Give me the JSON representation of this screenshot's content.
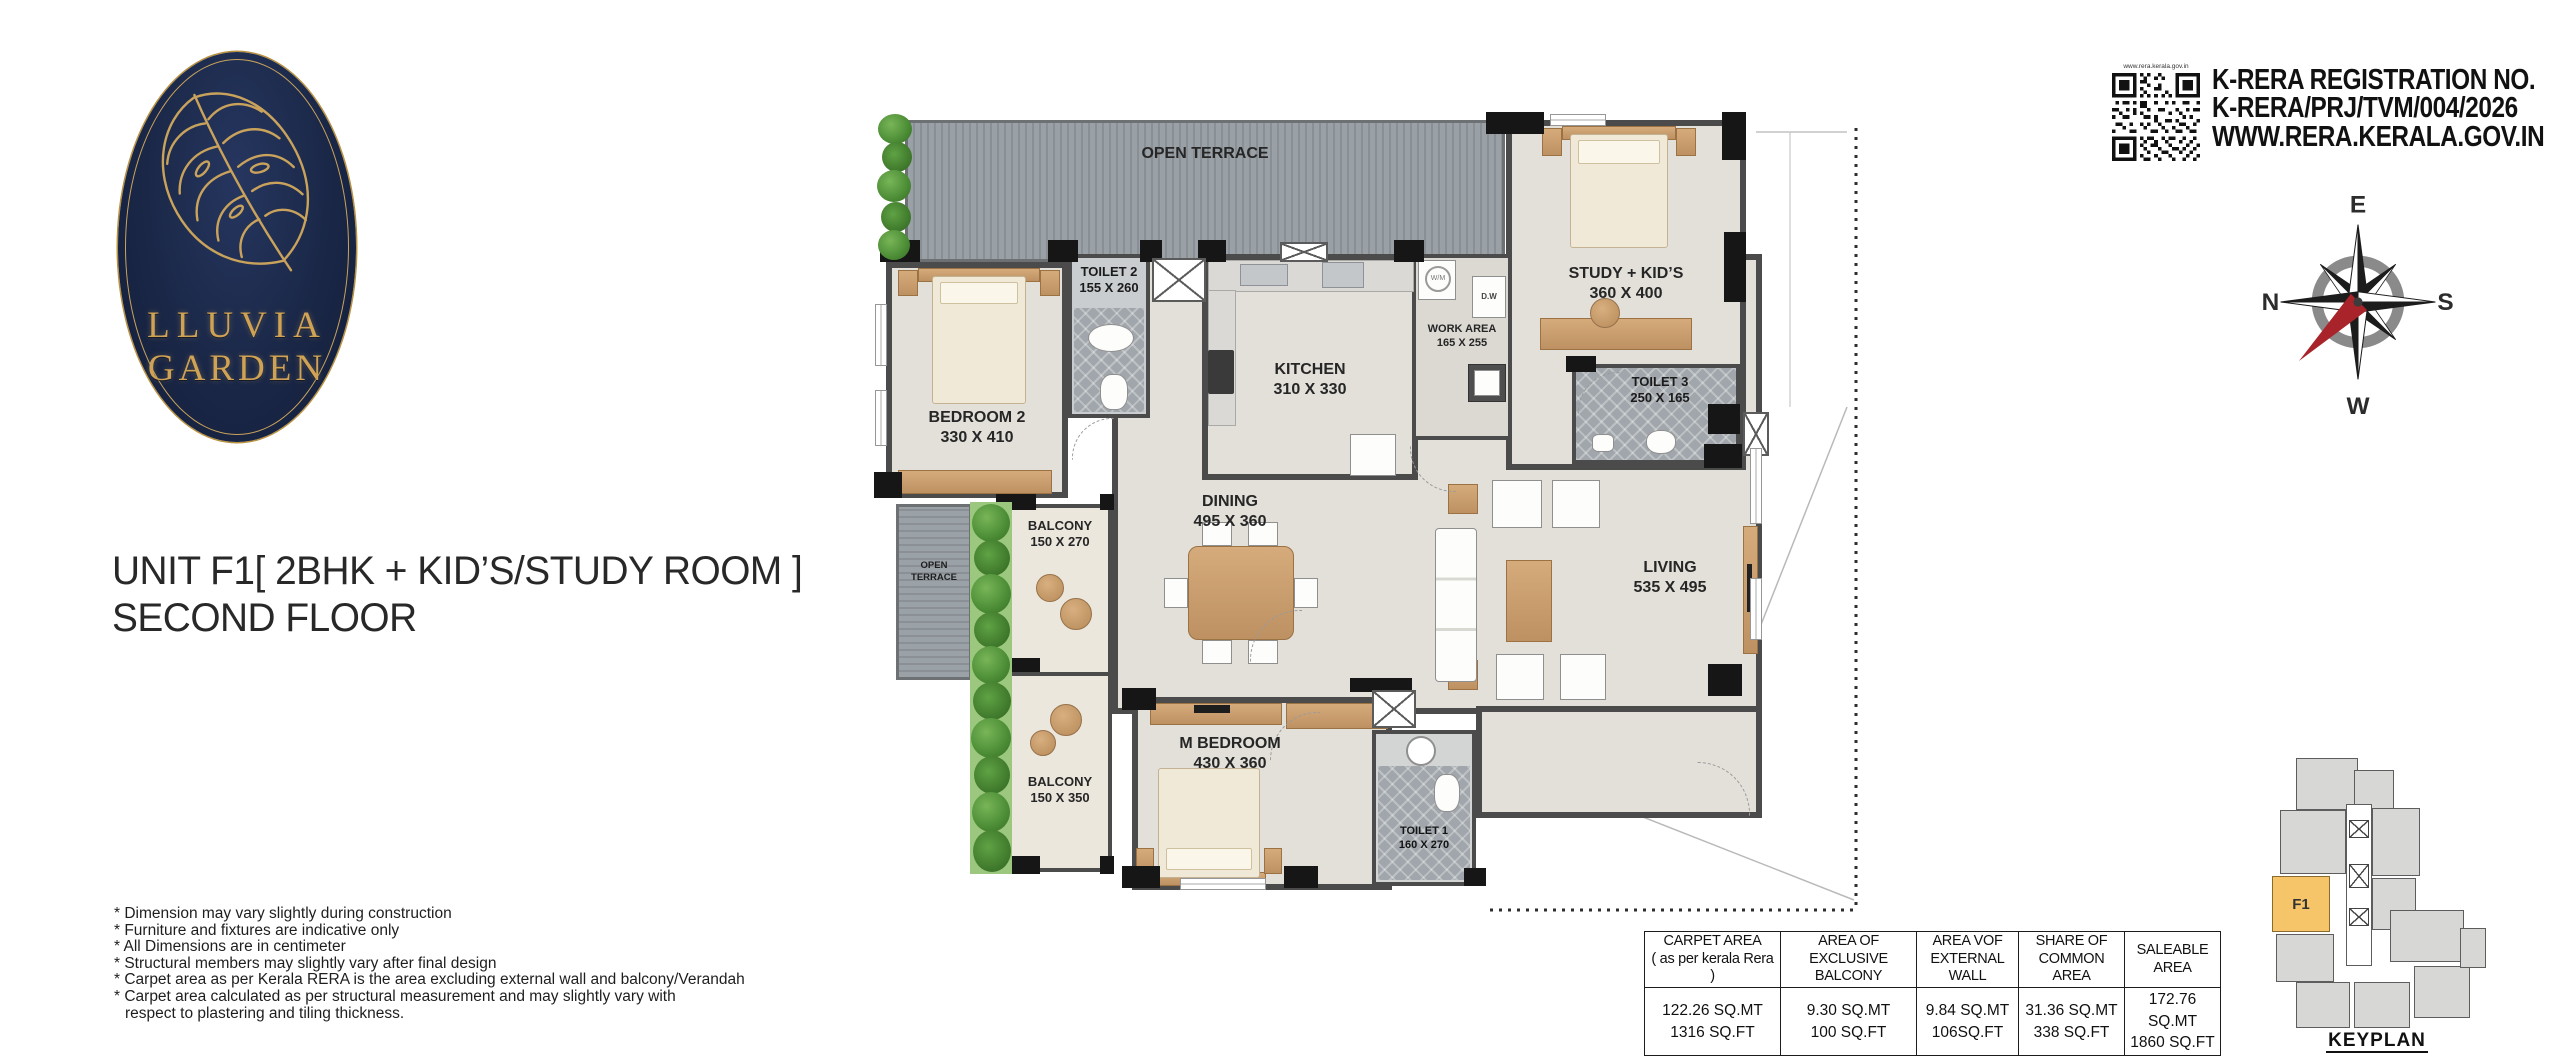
{
  "logo": {
    "name_line1": "LLUVIA",
    "name_line2": "GARDEN"
  },
  "title": {
    "line1": "UNIT F1[ 2BHK + KID’S/STUDY ROOM ]",
    "line2": "SECOND FLOOR"
  },
  "notes": [
    "* Dimension may vary slightly during construction",
    "* Furniture and fixtures are indicative only",
    "* All Dimensions are in centimeter",
    "* Structural members may slightly vary after final design",
    "* Carpet area as per Kerala RERA is the area excluding external wall and balcony/Verandah",
    "* Carpet area calculated as per structural measurement and may slightly vary with",
    "respect to plastering and tiling thickness."
  ],
  "rera": {
    "qr_caption": "www.rera.kerala.gov.in",
    "line1": "K-RERA REGISTRATION NO.",
    "line2": "K-RERA/PRJ/TVM/004/2026",
    "line3": "WWW.RERA.KERALA.GOV.IN"
  },
  "compass": {
    "top": "E",
    "right": "S",
    "bottom": "W",
    "left": "N"
  },
  "plan": {
    "rooms": {
      "open_terrace_top": {
        "name": "OPEN TERRACE"
      },
      "bedroom2": {
        "name": "BEDROOM 2",
        "dims": "330 X 410"
      },
      "toilet2": {
        "name": "TOILET 2",
        "dims": "155 X 260"
      },
      "kitchen": {
        "name": "KITCHEN",
        "dims": "310 X 330"
      },
      "work_area": {
        "name": "WORK AREA",
        "dims": "165 X 255"
      },
      "study": {
        "name": "STUDY + KID’S",
        "dims": "360 X 400"
      },
      "toilet3": {
        "name": "TOILET 3",
        "dims": "250 X 165"
      },
      "dining": {
        "name": "DINING",
        "dims": "495 X 360"
      },
      "living": {
        "name": "LIVING",
        "dims": "535 X 495"
      },
      "balcony1": {
        "name": "BALCONY",
        "dims": "150 X 270"
      },
      "open_terrace_left": {
        "line1": "OPEN",
        "line2": "TERRACE"
      },
      "balcony2": {
        "name": "BALCONY",
        "dims": "150 X 350"
      },
      "m_bedroom": {
        "name": "M BEDROOM",
        "dims": "430 X 360"
      },
      "toilet1": {
        "name": "TOILET 1",
        "dims": "160 X 270"
      }
    },
    "appliances": {
      "dw": "D.W",
      "wm": "W/M"
    }
  },
  "area_table": {
    "columns": [
      {
        "h1": "CARPET AREA",
        "h2": "( as per kerala Rera )",
        "sqmt": "122.26  SQ.MT",
        "sqft": "1316 SQ.FT"
      },
      {
        "h1": "AREA OF",
        "h2": "EXCLUSIVE BALCONY",
        "sqmt": "9.30 SQ.MT",
        "sqft": "100 SQ.FT"
      },
      {
        "h1": "AREA VOF",
        "h2": "EXTERNAL WALL",
        "sqmt": "9.84 SQ.MT",
        "sqft": "106SQ.FT"
      },
      {
        "h1": "SHARE OF",
        "h2": "COMMON AREA",
        "sqmt": "31.36 SQ.MT",
        "sqft": "338 SQ.FT"
      },
      {
        "h1": "SALEABLE AREA",
        "h2": "",
        "sqmt": "172.76  SQ.MT",
        "sqft": "1860 SQ.FT"
      }
    ]
  },
  "keyplan": {
    "label": "KEYPLAN",
    "unit": "F1"
  },
  "colors": {
    "logo_navy": "#1a2747",
    "logo_gold": "#c9a35c",
    "wall": "#4b4b4b",
    "floor": "#e3e0da",
    "terrace": "#8f969c",
    "keyplan_highlight": "#f6c469",
    "compass_red": "#a8232a",
    "plant_green": "#4f9038",
    "wood": "#c89d6e"
  }
}
